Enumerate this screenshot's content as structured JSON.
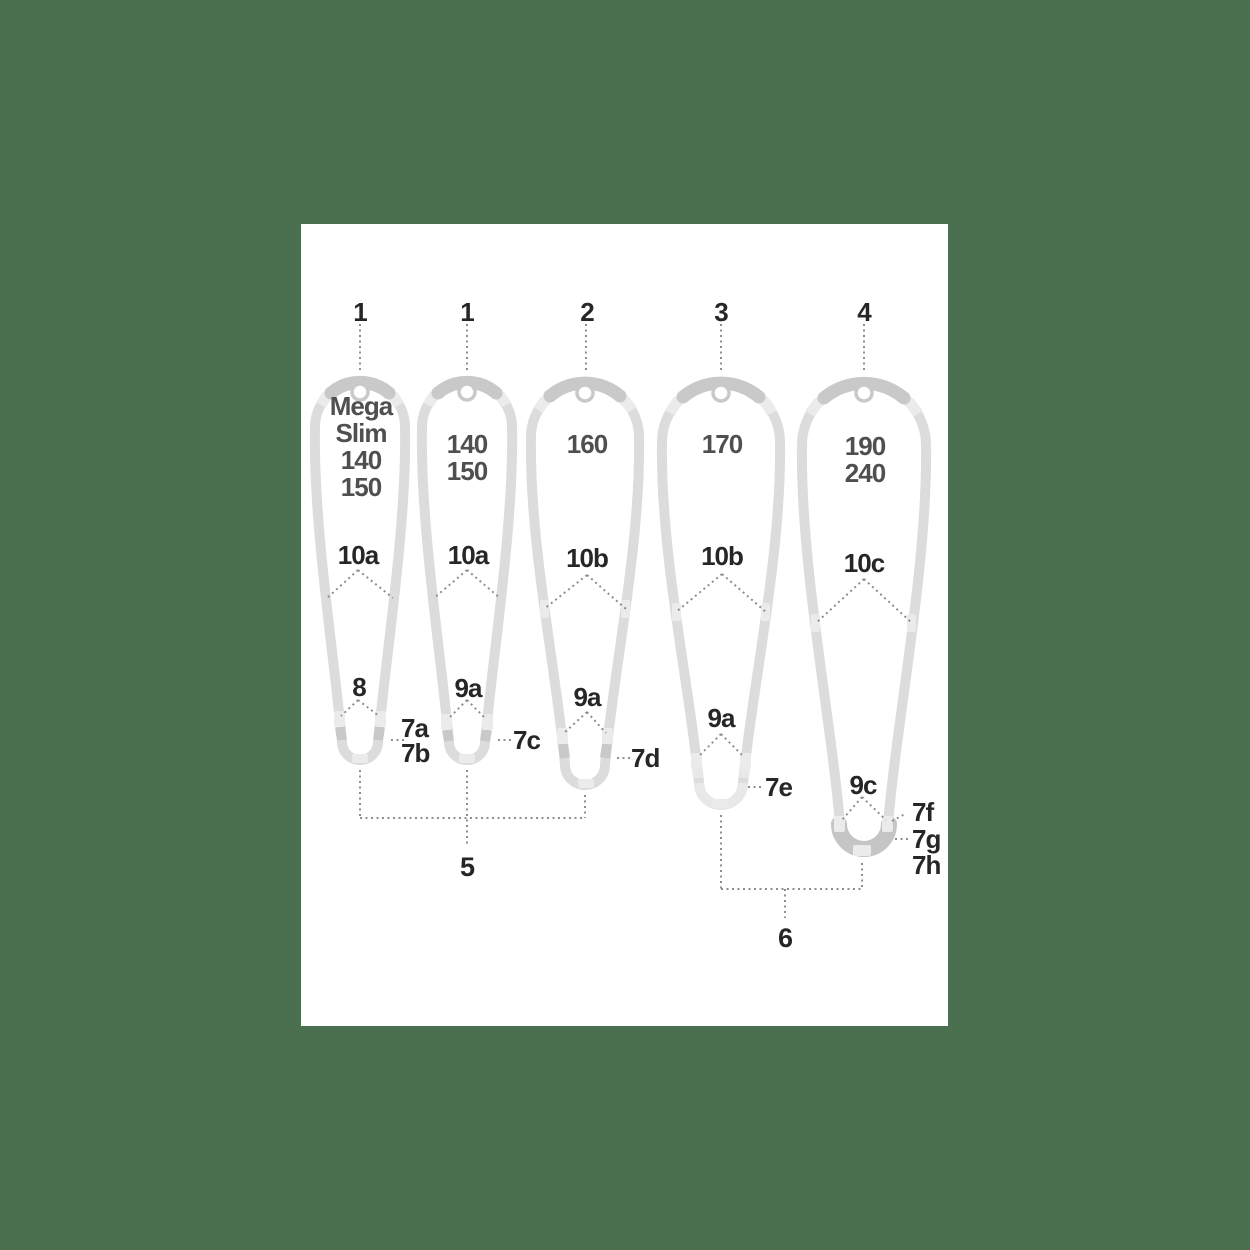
{
  "colors": {
    "background": "#4a7050",
    "panel": "#ffffff",
    "tube": "#dcdcdc",
    "tube_dark": "#c9c9c9",
    "tube_light": "#ebebeb",
    "heel": "#c5c5c5",
    "dots": "#8e8e8e",
    "label": "#262626",
    "size_text": "#4f4f4f"
  },
  "frames": [
    {
      "top_label": "1",
      "size_lines": [
        "Mega",
        "Slim",
        "140",
        "150"
      ],
      "rail_label": "10a",
      "spacer_label": "8",
      "callouts": [
        "7a",
        "7b"
      ]
    },
    {
      "top_label": "1",
      "size_lines": [
        "140",
        "150"
      ],
      "rail_label": "10a",
      "spacer_label": "9a",
      "callouts": [
        "7c"
      ]
    },
    {
      "top_label": "2",
      "size_lines": [
        "160"
      ],
      "rail_label": "10b",
      "spacer_label": "9a",
      "callouts": [
        "7d"
      ]
    },
    {
      "top_label": "3",
      "size_lines": [
        "170"
      ],
      "rail_label": "10b",
      "spacer_label": "9a",
      "callouts": [
        "7e"
      ]
    },
    {
      "top_label": "4",
      "size_lines": [
        "190",
        "240"
      ],
      "rail_label": "10c",
      "spacer_label": "9c",
      "callouts": [
        "7f",
        "7g",
        "7h"
      ]
    }
  ],
  "group_labels": {
    "left": "5",
    "right": "6"
  }
}
